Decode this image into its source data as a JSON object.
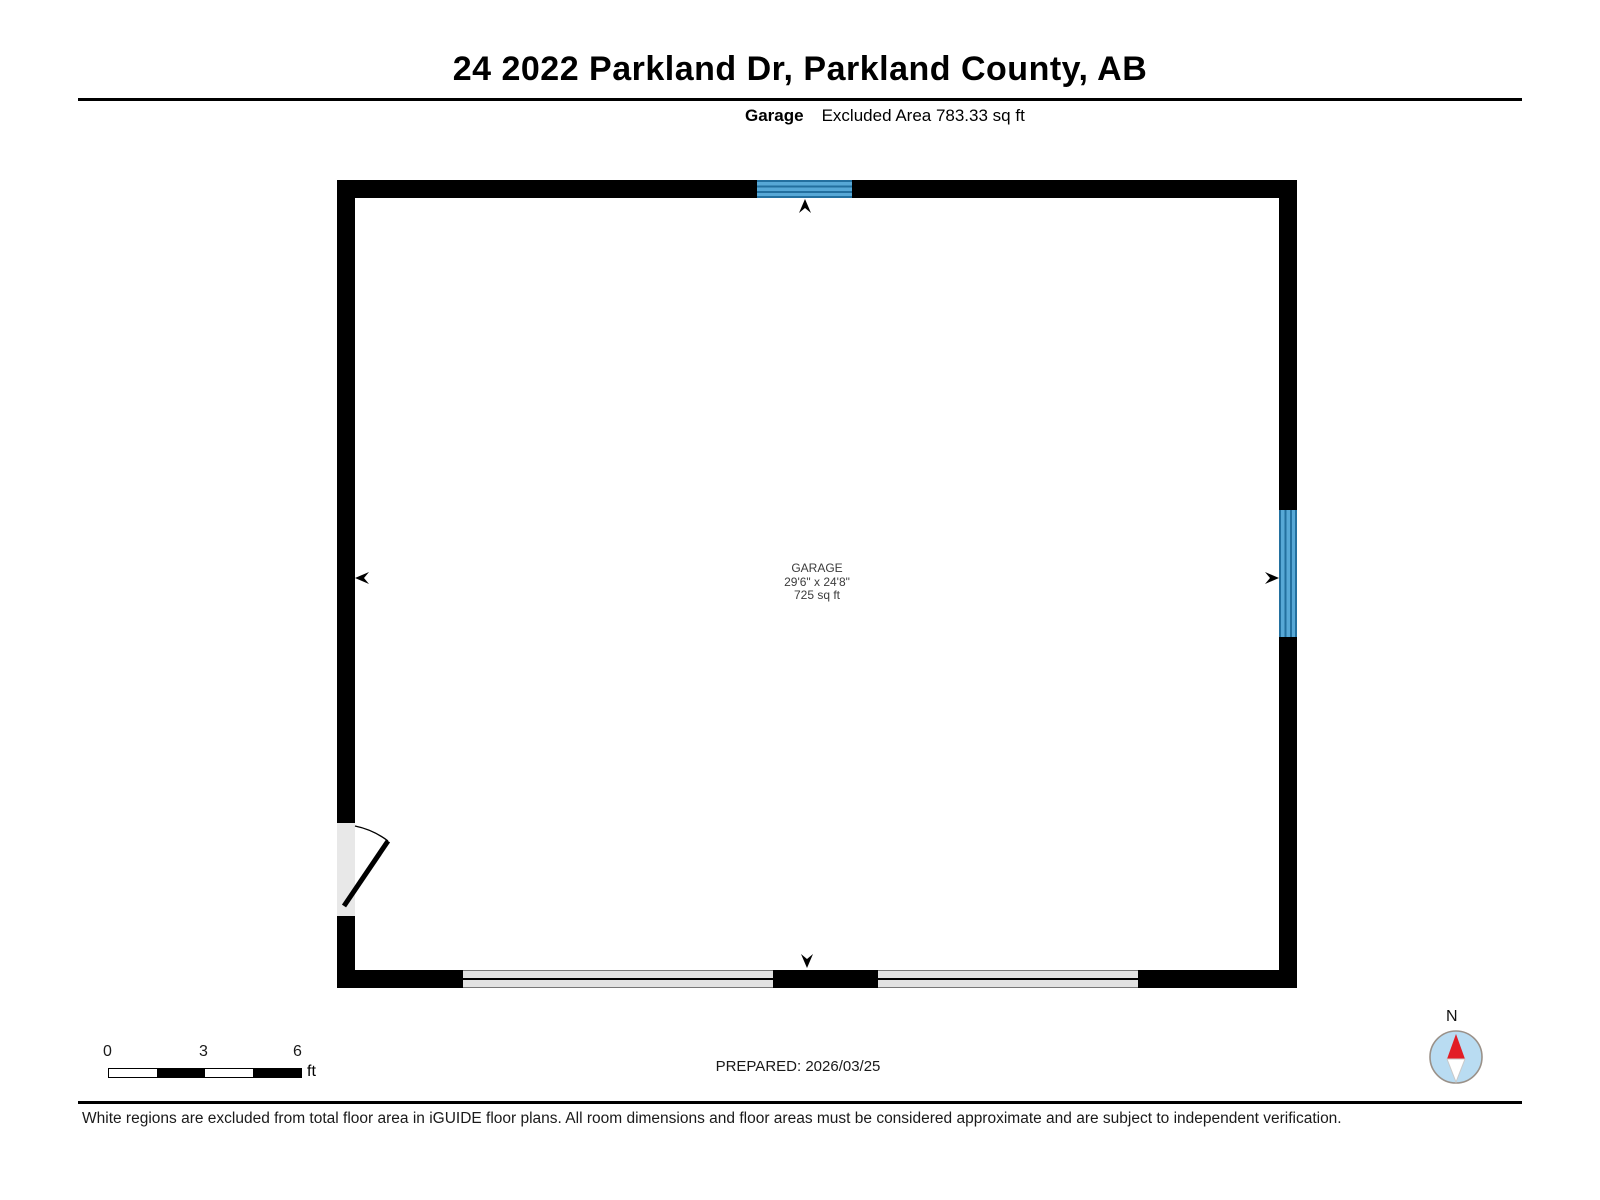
{
  "page": {
    "title": "24 2022 Parkland Dr, Parkland County, AB",
    "floor_label": "Garage",
    "excluded_area": "Excluded Area 783.33 sq ft",
    "prepared": "PREPARED: 2026/03/25",
    "disclaimer": "White regions are excluded from total floor area in iGUIDE floor plans. All room dimensions and floor areas must be considered approximate and are subject to independent verification."
  },
  "room": {
    "name": "GARAGE",
    "dimensions": "29'6\" x 24'8\"",
    "area": "725 sq ft"
  },
  "scale_bar": {
    "ticks": [
      "0",
      "3",
      "6"
    ],
    "unit": "ft"
  },
  "compass": {
    "label": "N"
  },
  "colors": {
    "wall": "#000000",
    "window_blue": "#57a8d6",
    "window_line": "#23709f",
    "garage_door_gray": "#e2e2e2",
    "door_opening_gray": "#e8e8e8",
    "compass_fill": "#b9dcf2",
    "compass_ring": "#9a9189",
    "needle_red": "#e21d25"
  }
}
